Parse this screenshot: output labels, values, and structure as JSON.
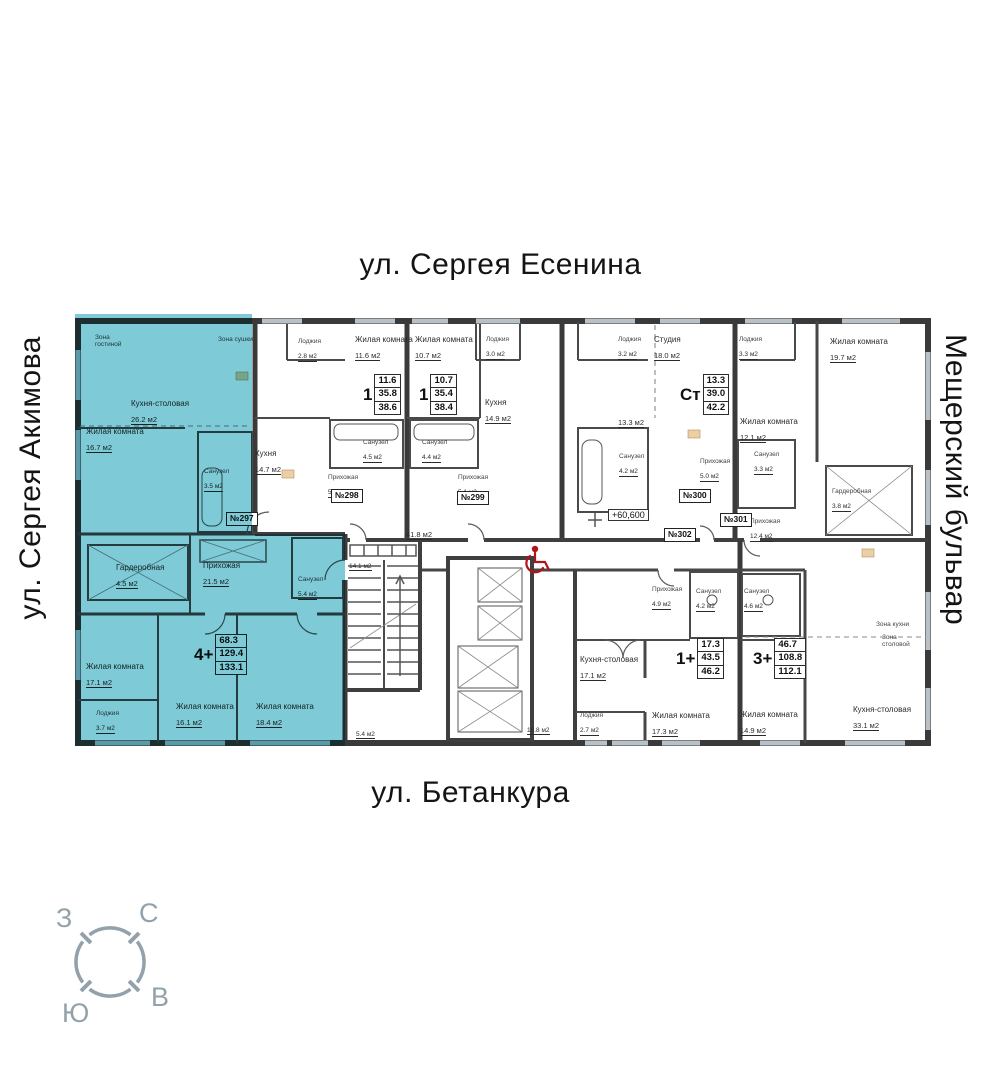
{
  "streets": {
    "top": "ул. Сергея Есенина",
    "left": "ул. Сергея Акимова",
    "right": "Мещерский бульвар",
    "bottom": "ул. Бетанкура"
  },
  "compass": {
    "west": "З",
    "north": "С",
    "east": "В",
    "south": "Ю"
  },
  "colors": {
    "highlight": "#7ecbd7",
    "accent_red": "#b3121a",
    "compass_gray": "#93a1ab",
    "wall": "#3a3a3a"
  },
  "plan": {
    "elevation_mark": "+60,600",
    "common_labels": [
      {
        "text": "41.8 м2",
        "x": 406,
        "y": 524
      },
      {
        "text": "14.1 м2",
        "x": 349,
        "y": 555,
        "small": true
      },
      {
        "text": "5.4 м2",
        "x": 356,
        "y": 723,
        "small": true
      },
      {
        "text": "16.8 м2",
        "x": 527,
        "y": 719,
        "small": true
      }
    ],
    "apartments": [
      {
        "number": "№297",
        "type": "4+",
        "living_area": "68.3",
        "floor_area": "129.4",
        "total_area": "133.1",
        "highlighted": true,
        "badge": {
          "x": 226,
          "y": 512
        },
        "label": {
          "x": 194,
          "y": 634
        },
        "rooms": [
          {
            "name": "Зона\nгостиной",
            "area": "",
            "x": 95,
            "y": 334,
            "small": true
          },
          {
            "name": "Зона сушки",
            "area": "",
            "x": 218,
            "y": 336,
            "small": true
          },
          {
            "name": "Кухня-столовая",
            "area": "26.2 м2",
            "x": 131,
            "y": 400
          },
          {
            "name": "Жилая комната",
            "area": "16.7 м2",
            "x": 86,
            "y": 428
          },
          {
            "name": "Санузел",
            "area": "3.5 м2",
            "x": 204,
            "y": 468,
            "small": true
          },
          {
            "name": "Гардеробная",
            "area": "4.5 м2",
            "x": 116,
            "y": 564
          },
          {
            "name": "Прихожая",
            "area": "21.5 м2",
            "x": 203,
            "y": 562
          },
          {
            "name": "Санузел",
            "area": "5.4 м2",
            "x": 298,
            "y": 576,
            "small": true
          },
          {
            "name": "Жилая комната",
            "area": "17.1 м2",
            "x": 86,
            "y": 663
          },
          {
            "name": "Лоджия",
            "area": "3.7 м2",
            "x": 96,
            "y": 710,
            "small": true
          },
          {
            "name": "Жилая комната",
            "area": "16.1 м2",
            "x": 176,
            "y": 703
          },
          {
            "name": "Жилая комната",
            "area": "18.4 м2",
            "x": 256,
            "y": 703
          }
        ]
      },
      {
        "number": "№298",
        "type": "1",
        "living_area": "11.6",
        "floor_area": "35.8",
        "total_area": "38.6",
        "highlighted": false,
        "badge": {
          "x": 331,
          "y": 489
        },
        "label": {
          "x": 363,
          "y": 374
        },
        "rooms": [
          {
            "name": "Лоджия",
            "area": "2.8 м2",
            "x": 298,
            "y": 338,
            "small": true
          },
          {
            "name": "Жилая комната",
            "area": "11.6 м2",
            "x": 355,
            "y": 336
          },
          {
            "name": "Санузел",
            "area": "4.5 м2",
            "x": 363,
            "y": 439,
            "small": true
          },
          {
            "name": "Кухня",
            "area": "14.7 м2",
            "x": 255,
            "y": 450
          },
          {
            "name": "Прихожая",
            "area": "5.0 м2",
            "x": 328,
            "y": 474,
            "small": true
          }
        ]
      },
      {
        "number": "№299",
        "type": "1",
        "living_area": "10.7",
        "floor_area": "35.4",
        "total_area": "38.4",
        "highlighted": false,
        "badge": {
          "x": 457,
          "y": 491
        },
        "label": {
          "x": 419,
          "y": 374
        },
        "rooms": [
          {
            "name": "Жилая комната",
            "area": "10.7 м2",
            "x": 415,
            "y": 336
          },
          {
            "name": "Лоджия",
            "area": "3.0 м2",
            "x": 486,
            "y": 336,
            "small": true
          },
          {
            "name": "Кухня",
            "area": "14.9 м2",
            "x": 485,
            "y": 399
          },
          {
            "name": "Санузел",
            "area": "4.4 м2",
            "x": 422,
            "y": 439,
            "small": true
          },
          {
            "name": "Прихожая",
            "area": "5.1 м2",
            "x": 458,
            "y": 474,
            "small": true
          }
        ]
      },
      {
        "number": "№300",
        "type": "Ст",
        "living_area": "13.3",
        "floor_area": "39.0",
        "total_area": "42.2",
        "highlighted": false,
        "badge": {
          "x": 679,
          "y": 489
        },
        "label": {
          "x": 680,
          "y": 374
        },
        "rooms": [
          {
            "name": "Лоджия",
            "area": "3.2 м2",
            "x": 618,
            "y": 336,
            "small": true
          },
          {
            "name": "Студия",
            "area": "18.0 м2",
            "x": 654,
            "y": 336
          },
          {
            "name": "",
            "area": "13.3 м2",
            "x": 618,
            "y": 412
          },
          {
            "name": "Санузел",
            "area": "4.2 м2",
            "x": 619,
            "y": 453,
            "small": true
          },
          {
            "name": "Прихожая",
            "area": "5.0 м2",
            "x": 700,
            "y": 458,
            "small": true
          }
        ]
      },
      {
        "number": "№301",
        "type": "3+",
        "living_area": "46.7",
        "floor_area": "108.8",
        "total_area": "112.1",
        "highlighted": false,
        "badge": {
          "x": 720,
          "y": 513
        },
        "label": {
          "x": 753,
          "y": 638
        },
        "rooms": [
          {
            "name": "Лоджия",
            "area": "3.3 м2",
            "x": 739,
            "y": 336,
            "small": true
          },
          {
            "name": "Жилая комната",
            "area": "12.1 м2",
            "x": 740,
            "y": 418
          },
          {
            "name": "Санузел",
            "area": "3.3 м2",
            "x": 754,
            "y": 451,
            "small": true
          },
          {
            "name": "Жилая комната",
            "area": "19.7 м2",
            "x": 830,
            "y": 338
          },
          {
            "name": "Гардеробная",
            "area": "3.8 м2",
            "x": 832,
            "y": 488,
            "small": true
          },
          {
            "name": "Прихожая",
            "area": "12.4 м2",
            "x": 750,
            "y": 518,
            "small": true
          },
          {
            "name": "Санузел",
            "area": "4.6 м2",
            "x": 744,
            "y": 588,
            "small": true
          },
          {
            "name": "Жилая комната",
            "area": "14.9 м2",
            "x": 740,
            "y": 711
          },
          {
            "name": "Кухня-столовая",
            "area": "33.1 м2",
            "x": 853,
            "y": 706
          },
          {
            "name": "Зона кухни",
            "area": "",
            "x": 876,
            "y": 621,
            "small": true
          },
          {
            "name": "Зона\nстоловой",
            "area": "",
            "x": 882,
            "y": 634,
            "small": true
          }
        ]
      },
      {
        "number": "№302",
        "type": "1+",
        "living_area": "17.3",
        "floor_area": "43.5",
        "total_area": "46.2",
        "highlighted": false,
        "badge": {
          "x": 664,
          "y": 528
        },
        "label": {
          "x": 676,
          "y": 638
        },
        "rooms": [
          {
            "name": "Прихожая",
            "area": "4.9 м2",
            "x": 652,
            "y": 586,
            "small": true
          },
          {
            "name": "Санузел",
            "area": "4.2 м2",
            "x": 696,
            "y": 588,
            "small": true
          },
          {
            "name": "Кухня-столовая",
            "area": "17.1 м2",
            "x": 580,
            "y": 656
          },
          {
            "name": "Лоджия",
            "area": "2.7 м2",
            "x": 580,
            "y": 712,
            "small": true
          },
          {
            "name": "Жилая комната",
            "area": "17.3 м2",
            "x": 652,
            "y": 712
          }
        ]
      }
    ]
  }
}
